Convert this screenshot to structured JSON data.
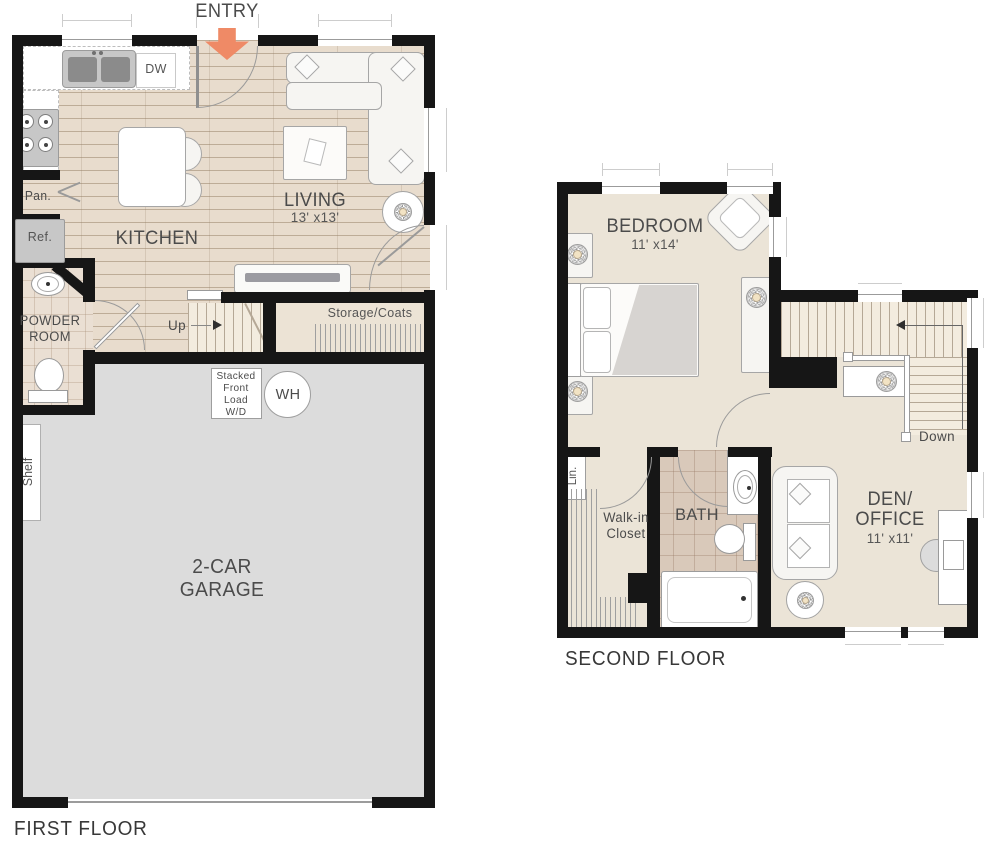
{
  "colors": {
    "wall": "#161616",
    "accent": "#ef8a66",
    "wood": "#e8dccd",
    "carpet": "#ebe4d7",
    "garage": "#dcdcdc",
    "tile": "#d9c9ba",
    "powder_tile": "#eadfd3",
    "stair": "#f3ecdf",
    "storage": "#ece3d5",
    "label": "#4b4b4b"
  },
  "entry": {
    "label": "ENTRY"
  },
  "floor1": {
    "title": "FIRST FLOOR",
    "kitchen": {
      "label": "KITCHEN",
      "dw": "DW",
      "pantry": "Pan.",
      "fridge": "Ref."
    },
    "living": {
      "label": "LIVING",
      "dims": "13' x13'"
    },
    "powder": {
      "line1": "POWDER",
      "line2": "ROOM"
    },
    "stairs": {
      "up": "Up"
    },
    "storage": {
      "label": "Storage/Coats"
    },
    "laundry": {
      "lines": [
        "Stacked",
        "Front",
        "Load",
        "W/D"
      ]
    },
    "water_heater": "WH",
    "shelf": "Shelf",
    "garage": {
      "line1": "2-CAR",
      "line2": "GARAGE"
    }
  },
  "floor2": {
    "title": "SECOND FLOOR",
    "bedroom": {
      "label": "BEDROOM",
      "dims": "11' x14'"
    },
    "closet": {
      "lin": "Lin.",
      "line1": "Walk-in",
      "line2": "Closet"
    },
    "bath": {
      "label": "BATH"
    },
    "den": {
      "line1": "DEN/",
      "line2": "OFFICE",
      "dims": "11' x11'"
    },
    "stairs": {
      "down": "Down"
    }
  }
}
